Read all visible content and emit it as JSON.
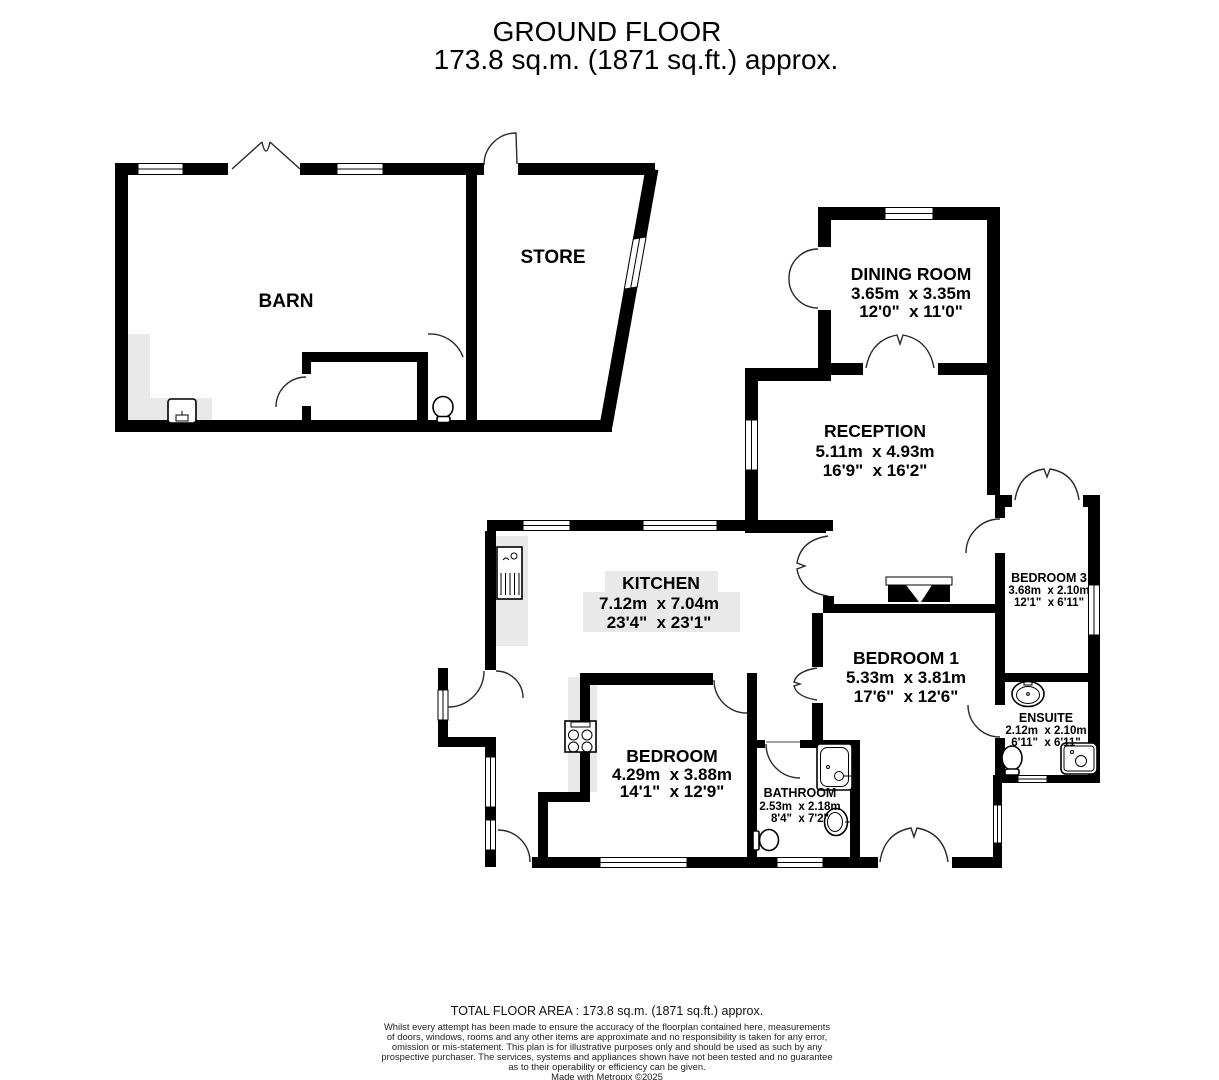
{
  "title": {
    "line1": "GROUND FLOOR",
    "line2": "173.8 sq.m. (1871 sq.ft.) approx."
  },
  "rooms": {
    "barn": {
      "name": "BARN"
    },
    "store": {
      "name": "STORE"
    },
    "dining": {
      "name": "DINING ROOM",
      "metric": "3.65m  x 3.35m",
      "imperial": "12'0\"  x 11'0\""
    },
    "reception": {
      "name": "RECEPTION",
      "metric": "5.11m  x 4.93m",
      "imperial": "16'9\"  x 16'2\""
    },
    "kitchen": {
      "name": "KITCHEN",
      "metric": "7.12m  x 7.04m",
      "imperial": "23'4\"  x 23'1\""
    },
    "bedroom1": {
      "name": "BEDROOM 1",
      "metric": "5.33m  x 3.81m",
      "imperial": "17'6\"  x 12'6\""
    },
    "bedroom3": {
      "name": "BEDROOM 3",
      "metric": "3.68m  x 2.10m",
      "imperial": "12'1\"  x 6'11\""
    },
    "ensuite": {
      "name": "ENSUITE",
      "metric": "2.12m  x 2.10m",
      "imperial": "6'11\"  x 6'11\""
    },
    "bedroom": {
      "name": "BEDROOM",
      "metric": "4.29m  x 3.88m",
      "imperial": "14'1\"  x 12'9\""
    },
    "bathroom": {
      "name": "BATHROOM",
      "metric": "2.53m  x 2.18m",
      "imperial": "8'4\"  x 7'2\""
    }
  },
  "footer": {
    "total": "TOTAL FLOOR AREA : 173.8 sq.m. (1871 sq.ft.) approx.",
    "disclaimer": [
      "Whilst every attempt has been made to ensure the accuracy of the floorplan contained here, measurements",
      "of doors, windows, rooms and any other items are approximate and no responsibility is taken for any error,",
      "omission or mis-statement. This plan is for illustrative purposes only and should be used as such by any",
      "prospective purchaser. The services, systems and appliances shown have not been tested and no guarantee",
      "as to their operability or efficiency can be given."
    ],
    "credit": "Made with Metropix ©2025"
  },
  "colors": {
    "wall": "#000000",
    "floor": "#ffffff",
    "counter": "#e9e9e9",
    "text": "#000000"
  }
}
